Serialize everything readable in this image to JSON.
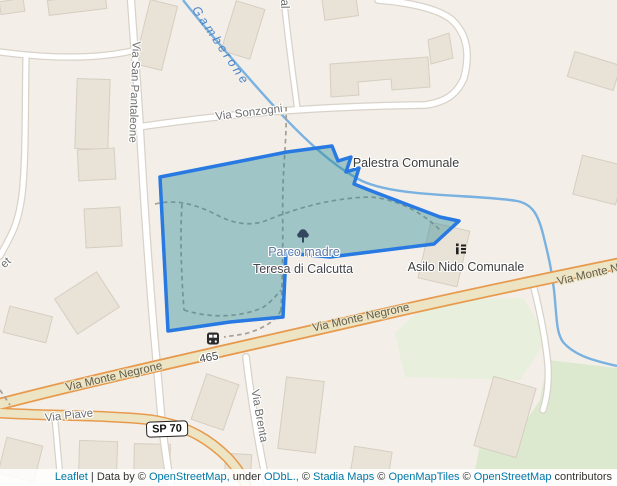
{
  "map": {
    "type": "leaflet-osm-map",
    "selected_feature": "park-polygon-overlay"
  },
  "colors": {
    "land": "#f3efe8",
    "building_fill": "#e8e2d7",
    "building_stroke": "#d6cec1",
    "road_white_fill": "#ffffff",
    "road_white_casing": "#d8d2c8",
    "road_tan_fill": "#ece4c2",
    "road_tan_casing": "#e79a4e",
    "green_area_light": "#e8efdc",
    "green_area_dark": "#dce9cf",
    "stream_blue": "#79b1e0",
    "water_label_blue": "#4d86c8",
    "park_overlay_fill": "rgba(45,138,150,0.42)",
    "park_overlay_stroke": "#2879e2",
    "path_dash_gray": "#a59f93",
    "street_label_gray": "#6e6e6e",
    "poi_label_dark": "#3d3d3d",
    "park_label_blue": "#5b7aa2",
    "park_label_dark": "#45454e",
    "attribution_link_blue": "#0078A8"
  },
  "water": {
    "name": "Gamberone"
  },
  "streets": {
    "san_pantaleone": "Via San Pantaleone",
    "sonzogni": "Via Sonzogni",
    "monte_negrone": "Via Monte Negrone",
    "monte_negrone_clipped": "Via Monte N",
    "piave": "Via Piave",
    "brenta": "Via Brenta",
    "fragment_left": "et",
    "fragment_top": "al"
  },
  "pois": {
    "palestra": "Palestra Comunale",
    "asilo": "Asilo Nido Comunale",
    "park_name_line1": "Parco madre",
    "park_name_line2": "Teresa di Calcutta"
  },
  "road_refs": {
    "provincial": "SP 70",
    "bus_stop": "465"
  },
  "icons": {
    "bus": "bus-icon",
    "tree": "tree-icon",
    "school": "school-icon"
  },
  "attribution": {
    "leaflet": "Leaflet",
    "separator": "|",
    "data_by": "Data by ©",
    "osm": "OpenStreetMap,",
    "under": "under",
    "odbl": "ODbL.,",
    "c1": "©",
    "stadia": "Stadia Maps",
    "c2": "©",
    "openmaptiles": "OpenMapTiles",
    "c3": "©",
    "osm2": "OpenStreetMap",
    "contributors": "contributors"
  }
}
